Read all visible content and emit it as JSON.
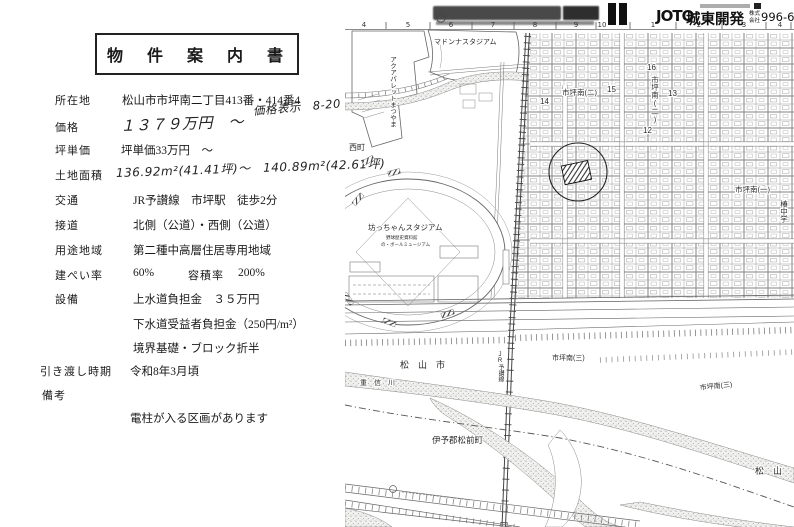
{
  "document": {
    "title": "物　件　案　内　書",
    "annotation": "価格表示　8-20",
    "rows": [
      {
        "label": "所在地",
        "value": "松山市市坪南二丁目413番・414番4"
      },
      {
        "label": "価格",
        "value": "１３７９万円　～"
      },
      {
        "label": "坪単価",
        "value": "坪単価33万円　～"
      },
      {
        "label": "土地面積",
        "value": "136.92m²(41.41坪)～　140.89m²(42.61坪)"
      },
      {
        "label": "交通",
        "value": "JR予讃線　市坪駅　徒歩2分"
      },
      {
        "label": "接道",
        "value": "北側（公道）・西側（公道）"
      },
      {
        "label": "用途地域",
        "value": "第二種中高層住居専用地域"
      },
      {
        "label": "建ぺい率",
        "value": "60%",
        "label2": "容積率",
        "value2": "200%"
      },
      {
        "label": "設備",
        "value": "上水道負担金　３５万円"
      },
      {
        "label": "",
        "value": "下水道受益者負担金（250円/m²）"
      },
      {
        "label": "",
        "value": "境界基礎・ブロック折半"
      },
      {
        "label": "引き渡し時期",
        "value": "令和8年3月頃"
      },
      {
        "label": "備考",
        "value": ""
      },
      {
        "label": "",
        "value": "電柱が入る区画があります"
      }
    ]
  },
  "header": {
    "logo": "JOTO",
    "company": "城東開発",
    "company_type_top": "株式",
    "company_type_bottom": "会社",
    "phone": "996-66"
  },
  "ruler": [
    "4",
    "5",
    "6",
    "7",
    "8",
    "9",
    "10",
    "1",
    "2",
    "3",
    "4"
  ],
  "map": {
    "labels": {
      "madonna_stadium": "マドンナスタジアム",
      "aqua_palette": "アクアパレットまつやま",
      "nishimachi": "西町",
      "botchan_stadium": "坊っちゃんスタジアム",
      "botchan_sub1": "野球歴史資料館",
      "botchan_sub2": "の・ボールミュージアム",
      "jr_line": "JR予讃線",
      "ichitsubo_minami2_a": "市坪南(二)",
      "ichitsubo_minami2_b": "市坪南(二)",
      "ichitsubo_minami1": "市坪南(一)",
      "ichitsubo_minami3_a": "市坪南(三)",
      "ichitsubo_minami3_b": "市坪南(三)",
      "tsubaki_junior_high": "椿中学",
      "matsuyama_city_a": "松　山　市",
      "matsuyama_city_b": "松　山",
      "shigenobu_river": "重　信　川",
      "iyogun_masakicho": "伊予郡松前町",
      "n12": "12",
      "n13": "13",
      "n14": "14",
      "n15": "15",
      "n16": "16"
    }
  }
}
